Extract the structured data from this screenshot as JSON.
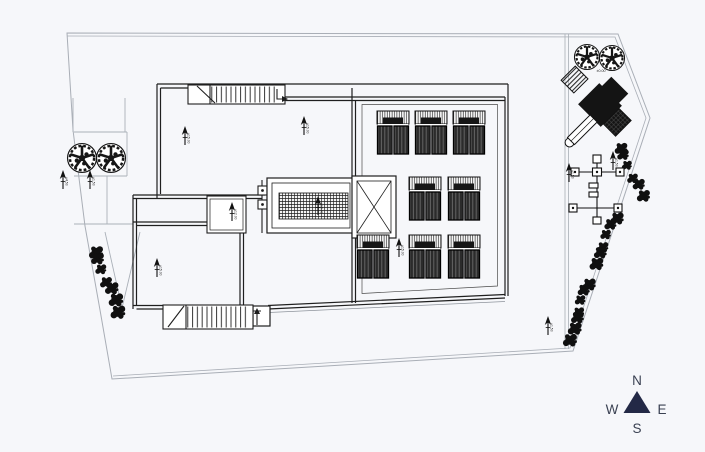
{
  "meta": {
    "background_color": "#f6f7fa",
    "drawing_line_color": "#1f1f1f",
    "boundary_line_color": "#a9aeb6",
    "compass_triangle_color": "#232946",
    "compass_text_color": "#3a4152"
  },
  "compass": {
    "n": "N",
    "e": "E",
    "s": "S",
    "w": "W"
  },
  "plan": {
    "solar_units": [
      {
        "x": 377,
        "y": 111
      },
      {
        "x": 415,
        "y": 111
      },
      {
        "x": 453,
        "y": 111
      },
      {
        "x": 409,
        "y": 177
      },
      {
        "x": 448,
        "y": 177
      },
      {
        "x": 357,
        "y": 235
      },
      {
        "x": 409,
        "y": 235
      },
      {
        "x": 448,
        "y": 235
      }
    ],
    "trees": [
      {
        "x": 82,
        "y": 158,
        "r": 15
      },
      {
        "x": 111,
        "y": 158,
        "r": 15
      },
      {
        "x": 587,
        "y": 57,
        "r": 13
      },
      {
        "x": 612,
        "y": 58,
        "r": 13
      }
    ],
    "shrub_chains": [
      {
        "x1": 96,
        "y1": 250,
        "x2": 117,
        "y2": 310,
        "n": 7,
        "r": 1.0
      },
      {
        "x1": 621,
        "y1": 146,
        "x2": 641,
        "y2": 196,
        "n": 6,
        "r": 0.9
      },
      {
        "x1": 617,
        "y1": 216,
        "x2": 594,
        "y2": 264,
        "n": 6,
        "r": 0.95
      },
      {
        "x1": 589,
        "y1": 282,
        "x2": 569,
        "y2": 338,
        "n": 7,
        "r": 0.95
      }
    ],
    "level_markers": [
      {
        "x": 63,
        "y": 170,
        "label": "+4.50"
      },
      {
        "x": 90,
        "y": 170,
        "label": "+1.50"
      },
      {
        "x": 185,
        "y": 126,
        "label": "+15.00"
      },
      {
        "x": 304,
        "y": 116,
        "label": "+15.00"
      },
      {
        "x": 232,
        "y": 202,
        "label": "+12.00"
      },
      {
        "x": 318,
        "y": 196,
        "label": "+15.00"
      },
      {
        "x": 157,
        "y": 258,
        "label": "+15.00"
      },
      {
        "x": 399,
        "y": 238,
        "label": "+15.00"
      },
      {
        "x": 548,
        "y": 316,
        "label": "+1.50"
      },
      {
        "x": 569,
        "y": 163,
        "label": "+1.50"
      },
      {
        "x": 613,
        "y": 151,
        "label": "+1.50"
      }
    ],
    "tiny_labels": [
      {
        "x": 601,
        "y": 72,
        "text": "±0.00"
      }
    ]
  }
}
